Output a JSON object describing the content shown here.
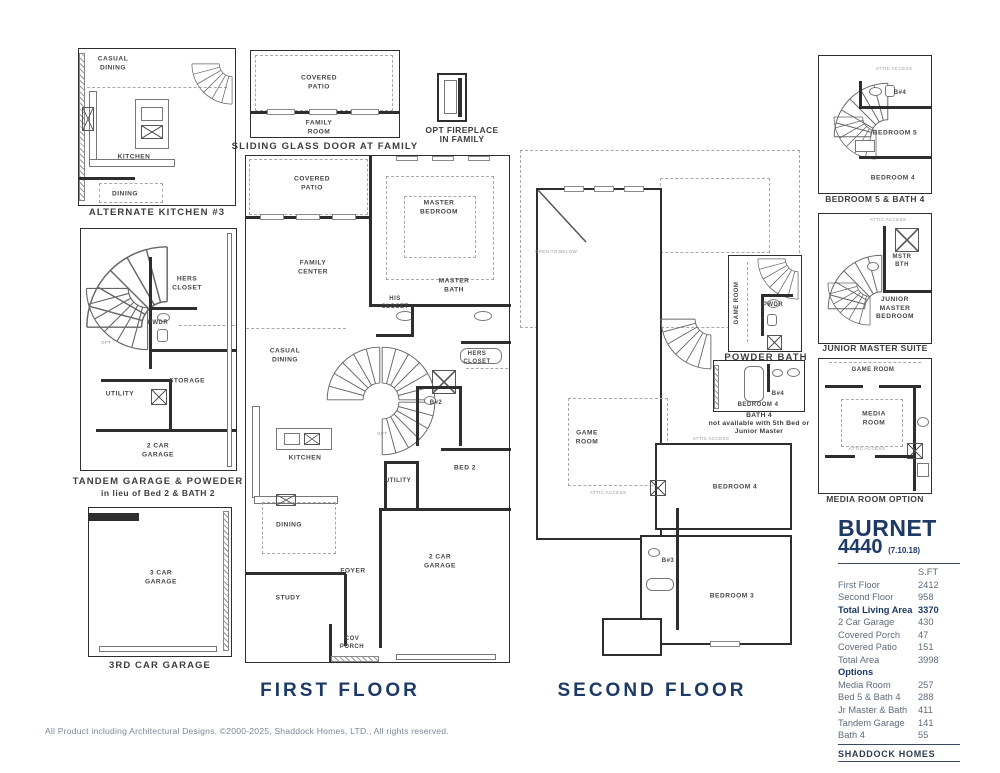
{
  "colors": {
    "navy": "#1d3966",
    "caption_gray": "#3d3d3d",
    "table_text": "#5f6b7a",
    "wall": "#2e2e2e"
  },
  "captions": {
    "alternate_kitchen": "ALTERNATE KITCHEN #3",
    "sliding_glass": "SLIDING GLASS DOOR AT FAMILY",
    "opt_fireplace": [
      "OPT FIREPLACE",
      "IN FAMILY"
    ],
    "tandem": [
      "TANDEM GARAGE & POWEDER",
      "in lieu of Bed 2 & BATH 2"
    ],
    "third_garage": "3RD CAR GARAGE",
    "first_floor": "FIRST FLOOR",
    "second_floor": "SECOND FLOOR",
    "powder_bath": "POWDER BATH",
    "bath4": [
      "BATH 4",
      "not available with 5th Bed or",
      "Junior Master"
    ],
    "bed5_bath4": "BEDROOM 5 & BATH 4",
    "junior_master": "JUNIOR MASTER SUITE",
    "media_room": "MEDIA ROOM OPTION"
  },
  "rooms": {
    "alt_kitchen": [
      "CASUAL DINING",
      "KITCHEN",
      "DINING"
    ],
    "sliding": [
      "COVERED PATIO",
      "FAMILY ROOM"
    ],
    "tandem": [
      "HERS CLOSET",
      "PWDR",
      "OPT",
      "STORAGE",
      "UTILITY",
      "2 CAR GARAGE"
    ],
    "garage3": [
      "3 CAR GARAGE"
    ],
    "first_floor": [
      "COVERED PATIO",
      "MASTER BEDROOM",
      "FAMILY CENTER",
      "MASTER BATH",
      "HIS CLOSET",
      "CASUAL DINING",
      "HERS CLOSET",
      "B#2",
      "KITCHEN",
      "UTILITY",
      "BED 2",
      "DINING",
      "FOYER",
      "STUDY",
      "2 CAR GARAGE",
      "COV PORCH",
      "OPT"
    ],
    "second_floor": [
      "OPEN TO BELOW",
      "GAME ROOM",
      "ATTIC ACCESS",
      "ATTIC ACCESS",
      "BEDROOM 4",
      "B#3",
      "BEDROOM 3"
    ],
    "powder": [
      "GAME ROOM",
      "PWDR"
    ],
    "bath4": [
      "B#4",
      "BEDROOM 4"
    ],
    "bed5": [
      "ATTIC ACCESS",
      "B#4",
      "BEDROOM 5",
      "BEDROOM 4"
    ],
    "junior": [
      "ATTIC ACCESS",
      "MSTR BTH",
      "JUNIOR MASTER BEDROOM"
    ],
    "media": [
      "GAME ROOM",
      "MEDIA ROOM",
      "ATTIC ACCESS"
    ]
  },
  "info": {
    "title": "BURNET",
    "number": "4440",
    "revision": "(7.10.18)",
    "unit_header": "S.FT",
    "rows": [
      {
        "label": "First Floor",
        "value": "2412"
      },
      {
        "label": "Second Floor",
        "value": "958"
      },
      {
        "label": "Total Living Area",
        "value": "3370"
      },
      {
        "label": "2 Car Garage",
        "value": "430"
      },
      {
        "label": "Covered Porch",
        "value": "47"
      },
      {
        "label": "Covered Patio",
        "value": "151"
      },
      {
        "label": "Total Area",
        "value": "3998"
      }
    ],
    "options_header": "Options",
    "option_rows": [
      {
        "label": "Media Room",
        "value": "257"
      },
      {
        "label": "Bed 5 & Bath 4",
        "value": "288"
      },
      {
        "label": "Jr Master & Bath",
        "value": "411"
      },
      {
        "label": "Tandem Garage",
        "value": "141"
      },
      {
        "label": "Bath 4",
        "value": "55"
      }
    ],
    "brand": "SHADDOCK HOMES"
  },
  "footer": {
    "copyright": "All Product including Architectural Designs, ©2000-2025, Shaddock Homes, LTD., All rights reserved."
  }
}
